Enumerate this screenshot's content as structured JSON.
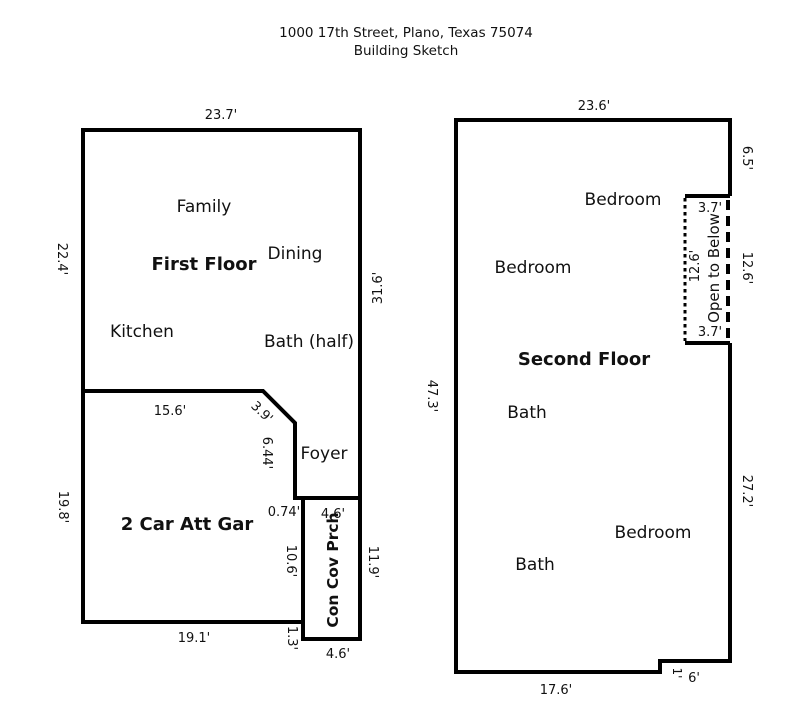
{
  "header": {
    "address": "1000 17th Street, Plano, Texas 75074",
    "subtitle": "Building Sketch",
    "color": "#E8973F"
  },
  "first_floor": {
    "title": "First Floor",
    "rooms": {
      "family": "Family",
      "dining": "Dining",
      "kitchen": "Kitchen",
      "bath_half": "Bath (half)",
      "foyer": "Foyer",
      "garage": "2 Car Att Gar",
      "porch": "Con Cov Prch"
    },
    "dimensions": {
      "top_width": "23.7'",
      "left_upper": "22.4'",
      "right_height": "31.6'",
      "kitchen_wall": "15.6'",
      "diagonal": "3.9'",
      "foyer_wall": "6.44'",
      "jog": "0.74'",
      "porch_top": "4.6'",
      "garage_left": "19.8'",
      "garage_right": "10.6'",
      "porch_right": "11.9'",
      "garage_bottom": "19.1'",
      "step": "1.3'",
      "porch_bottom": "4.6'"
    }
  },
  "second_floor": {
    "title": "Second Floor",
    "rooms": {
      "bedroom_top": "Bedroom",
      "bedroom_mid": "Bedroom",
      "bedroom_bottom": "Bedroom",
      "bath_upper": "Bath",
      "bath_lower": "Bath",
      "open_to_below": "Open to Below"
    },
    "dimensions": {
      "top_width": "23.6'",
      "right_upper": "6.5'",
      "open_top": "3.7'",
      "open_left": "12.6'",
      "open_right": "12.6'",
      "open_bottom": "3.7'",
      "left_height": "47.3'",
      "right_lower": "27.2'",
      "bottom_width": "17.6'",
      "notch_height": "1'",
      "notch_width": "6'"
    }
  }
}
